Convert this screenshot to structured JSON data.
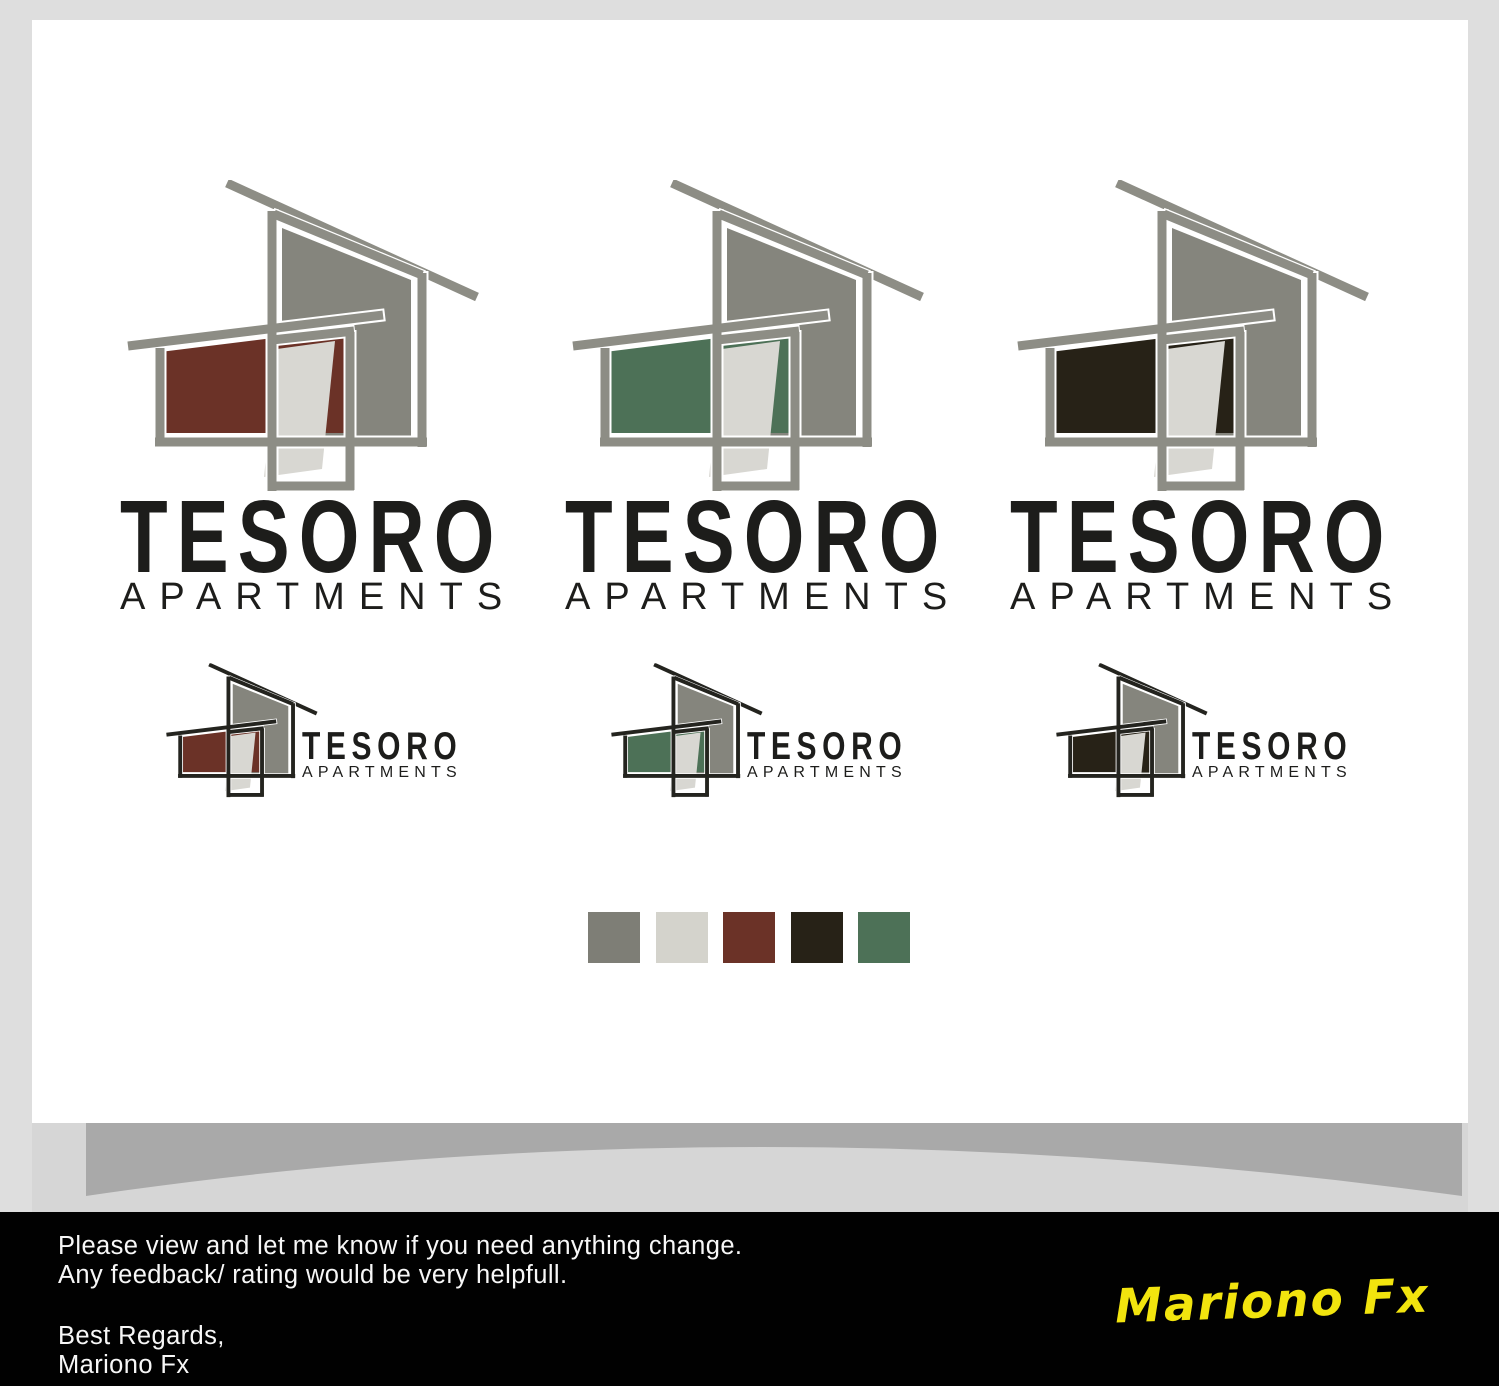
{
  "brand": {
    "name": "TESORO",
    "tagline": "APARTMENTS"
  },
  "logo_variants": [
    {
      "id": "brick-red",
      "accent": "#6b3227"
    },
    {
      "id": "green",
      "accent": "#4d7157"
    },
    {
      "id": "dark-brown",
      "accent": "#272217"
    }
  ],
  "icon_colors": {
    "large_stroke": "#8d8d85",
    "small_stroke": "#24241f",
    "house_fill": "#85857d",
    "door_fill": "#d8d7d2"
  },
  "palette": [
    "#7e7e76",
    "#d4d3cc",
    "#6b3227",
    "#272217",
    "#4d7157"
  ],
  "band": {
    "dark": "#a9a9a9",
    "light": "#d6d6d6"
  },
  "footer": {
    "line1": "Please view and let me know if you need anything change.",
    "line2": "Any feedback/ rating would be very helpfull.",
    "closing": "Best Regards,",
    "author": "Mariono Fx",
    "signature": "Mariono Fx",
    "signature_color": "#f2e40e"
  }
}
